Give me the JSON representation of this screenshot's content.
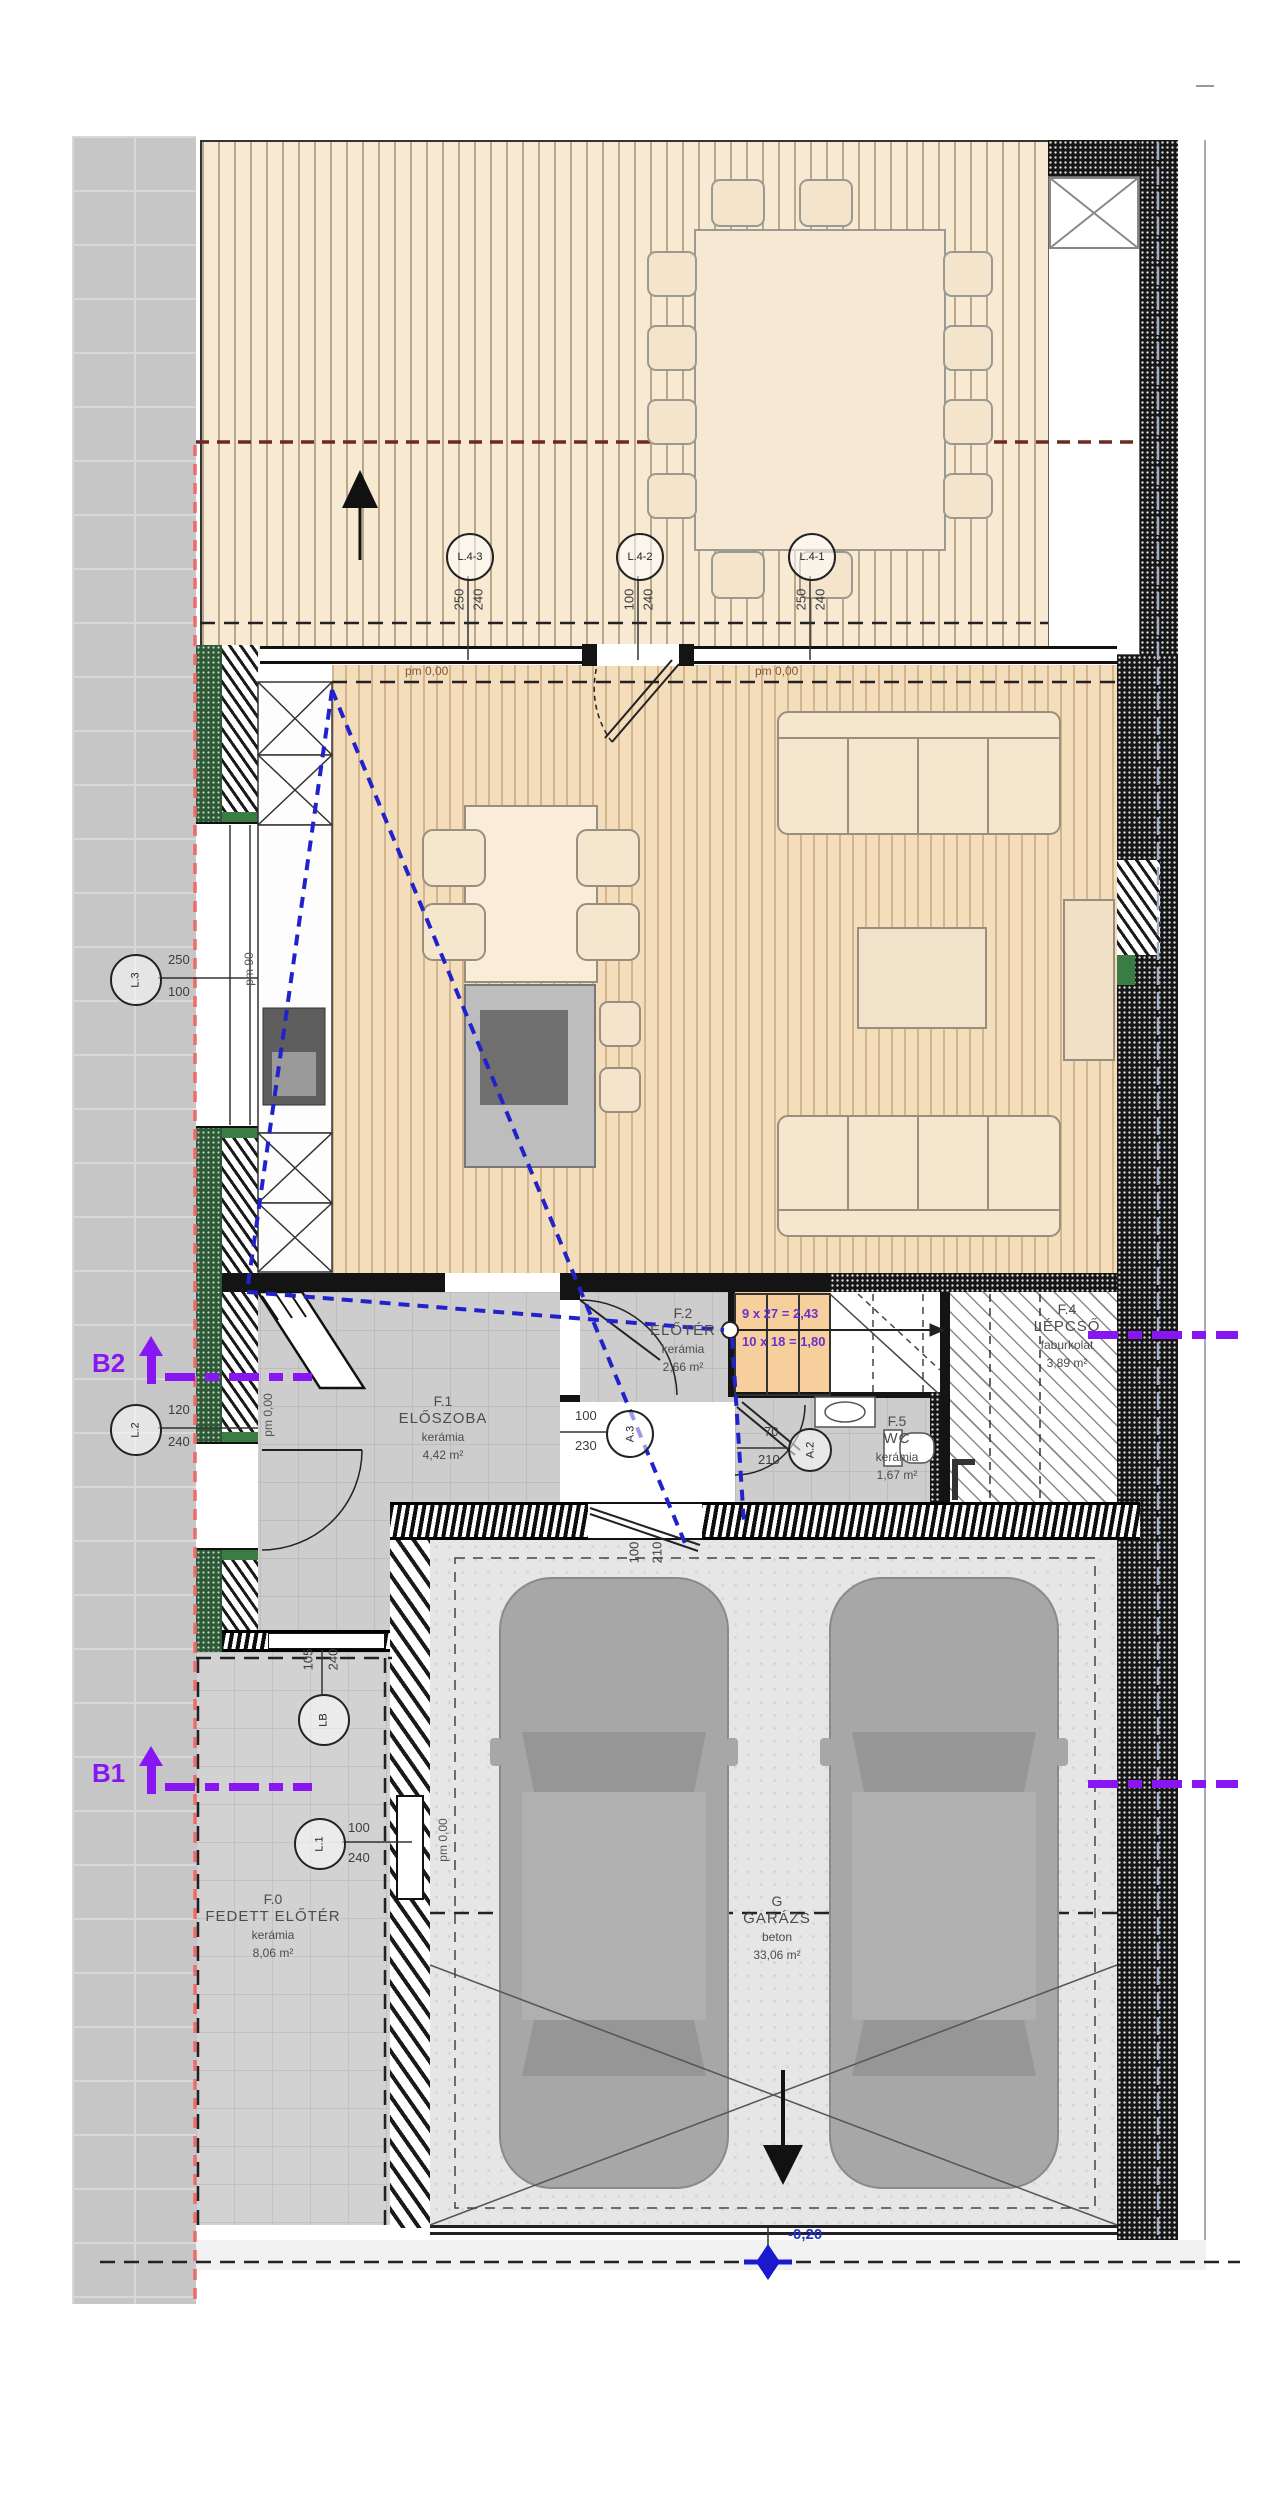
{
  "rooms": {
    "f0": {
      "id": "F.0",
      "name": "FEDETT ELŐTÉR",
      "material": "kerámia",
      "area": "8,06 m²"
    },
    "f1": {
      "id": "F.1",
      "name": "ELŐSZOBA",
      "material": "kerámia",
      "area": "4,42 m²"
    },
    "f2": {
      "id": "F.2",
      "name": "ELŐTÉR",
      "material": "kerámia",
      "area": "2,66 m²"
    },
    "f4": {
      "id": "F.4",
      "name": "LÉPCSŐ",
      "material": "faburkolat",
      "area": "3,89 m²"
    },
    "f5": {
      "id": "F.5",
      "name": "WC",
      "material": "kerámia",
      "area": "1,67 m²"
    },
    "g": {
      "id": "G",
      "name": "GARÁZS",
      "material": "beton",
      "area": "33,06 m²"
    }
  },
  "openings": {
    "l43": {
      "label": "L.4-3",
      "w": "250",
      "h": "240"
    },
    "l42": {
      "label": "L.4-2",
      "w": "100",
      "h": "240"
    },
    "l41": {
      "label": "L.4-1",
      "w": "250",
      "h": "240"
    },
    "l3": {
      "label": "L.3",
      "w": "250",
      "h": "100"
    },
    "l2": {
      "label": "L.2",
      "w": "120",
      "h": "240"
    },
    "l1": {
      "label": "L.1",
      "w": "100",
      "h": "240"
    },
    "lb": {
      "label": "LB",
      "w": "105",
      "h": "240"
    },
    "a3": {
      "label": "A.3",
      "w": "100",
      "h": "230"
    },
    "a2": {
      "label": "A.2",
      "w": "70",
      "h": "210"
    },
    "garage_inner_door": {
      "w": "100",
      "h": "210"
    }
  },
  "levels": {
    "terrace_left": "pm 0,00",
    "living_right": "pm 0,00",
    "kitchen": "pm 90",
    "hall": "pm 0,00",
    "garage_entry": "pm 0,00",
    "driveway": "-0,20"
  },
  "sections": {
    "b1": "B1",
    "b2": "B2"
  },
  "stair": {
    "note1": "9 x 27 = 2,43",
    "note2": "10 x 18 = 1,80"
  },
  "colors": {
    "section_line": "#8816f2",
    "sight_line": "#2222cc",
    "boundary_line": "#e06a6a",
    "stair_note": "#6633cc",
    "level_marker": "#2233cc"
  }
}
